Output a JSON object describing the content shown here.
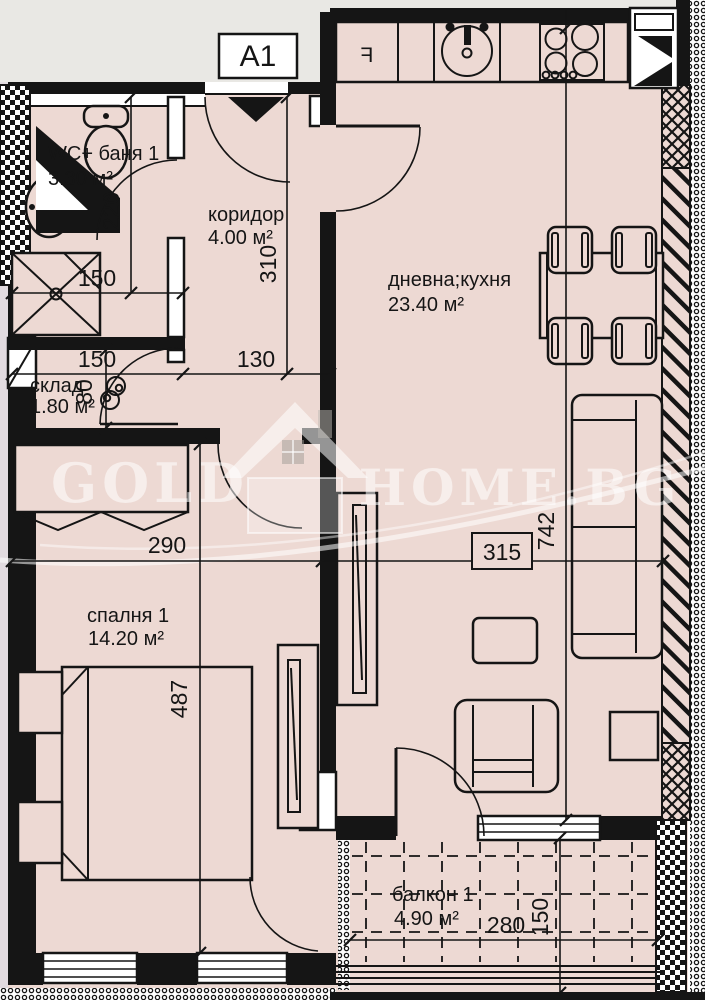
{
  "plan": {
    "unit_label": "A1",
    "watermark": {
      "word1": "GOLD",
      "word2": "HOME.BG"
    },
    "rooms": {
      "wc": {
        "name": "WC+ баня 1",
        "area": "3.30 м²"
      },
      "corridor": {
        "name": "коридор",
        "area": "4.00 м²"
      },
      "living": {
        "name": "дневна;кухня",
        "area": "23.40 м²"
      },
      "storage": {
        "name": "склад",
        "area": "1.80 м²"
      },
      "bedroom": {
        "name": "спалня 1",
        "area": "14.20 м²"
      },
      "balcony": {
        "name": "балкон 1",
        "area": "4.90 м²"
      }
    },
    "dims": {
      "d220": "220",
      "d310": "310",
      "d150a": "150",
      "d150b": "150",
      "d130": "130",
      "d80": "80",
      "d290": "290",
      "d315": "315",
      "d742": "742",
      "d487": "487",
      "d280": "280",
      "d150c": "150"
    },
    "kitchen": {
      "fridge": "F"
    },
    "colors": {
      "floor": "#edd9d3",
      "outside": "#e9e8e4",
      "wall": "#151515"
    }
  }
}
